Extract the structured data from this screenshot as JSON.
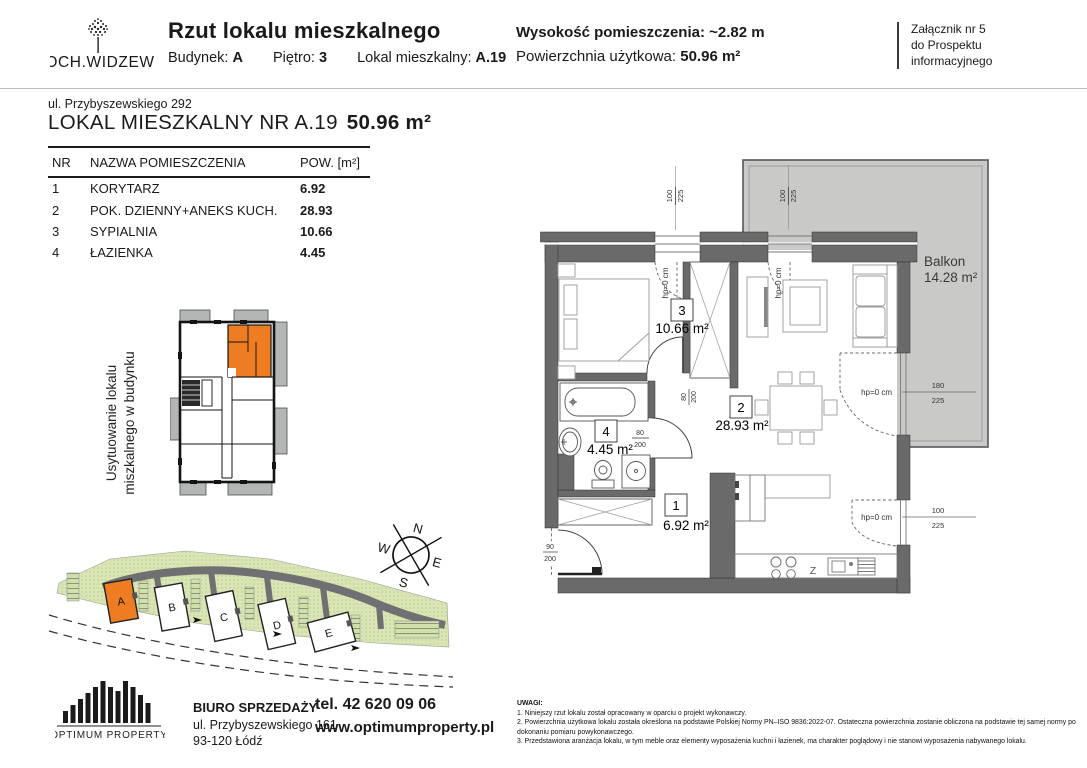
{
  "page": {
    "accent_orange": "#ee7c22",
    "wall_gray": "#6a6a6a",
    "balcony_gray": "#c9cac8"
  },
  "header": {
    "logo_text": "OCH.WIDZEW",
    "title": "Rzut lokalu mieszkalnego",
    "building_label": "Budynek:",
    "building_value": "A",
    "floor_label": "Piętro:",
    "floor_value": "3",
    "unit_label": "Lokal mieszkalny:",
    "unit_value": "A.19",
    "height_line": "Wysokość pomieszczenia: ~2.82 m",
    "area_label": "Powierzchnia użytkowa:",
    "area_value": "50.96 m²",
    "attachment_line1": "Załącznik nr 5",
    "attachment_line2": "do Prospektu",
    "attachment_line3": "informacyjnego"
  },
  "unit": {
    "address": "ul. Przybyszewskiego 292",
    "title": "LOKAL MIESZKALNY NR A.19",
    "title_area": "50.96 m²"
  },
  "rooms_table": {
    "col_nr": "NR",
    "col_name": "NAZWA POMIESZCZENIA",
    "col_area": "POW. [m²]",
    "rows": [
      {
        "nr": "1",
        "name": "KORYTARZ",
        "area": "6.92"
      },
      {
        "nr": "2",
        "name": "POK. DZIENNY+ANEKS KUCH.",
        "area": "28.93"
      },
      {
        "nr": "3",
        "name": "SYPIALNIA",
        "area": "10.66"
      },
      {
        "nr": "4",
        "name": "ŁAZIENKA",
        "area": "4.45"
      }
    ]
  },
  "location_diagram": {
    "label_line1": "Usytuowanie lokalu",
    "label_line2": "miszkalnego w budynku"
  },
  "site_map": {
    "building_a": "A",
    "building_b": "B",
    "building_c": "C",
    "building_d": "D",
    "building_e": "E",
    "compass_n": "N",
    "compass_e": "E",
    "compass_s": "S",
    "compass_w": "W"
  },
  "floor_plan": {
    "room1_nr": "1",
    "room1_area": "6.92 m²",
    "room2_nr": "2",
    "room2_area": "28.93 m²",
    "room3_nr": "3",
    "room3_area": "10.66 m²",
    "room4_nr": "4",
    "room4_area": "4.45 m²",
    "balcony_name": "Balkon",
    "balcony_area": "14.28 m²",
    "dim_hp": "hp=0 cm",
    "win_top_w": "100",
    "win_top_h": "225",
    "balcony_door_w": "180",
    "balcony_door_h": "225",
    "win_right_w": "100",
    "win_right_h": "225",
    "door_w": "80",
    "door_h": "200",
    "entry_w": "90",
    "entry_h": "200",
    "sink_label": "Z"
  },
  "footer": {
    "brand": "OPTIMUM PROPERTY",
    "office_title": "BIURO SPRZEDAŻY",
    "office_address": "ul. Przybyszewskiego 161",
    "office_city": "93-120 Łódź",
    "phone": "tel. 42 620 09 06",
    "website": "www.optimumproperty.pl"
  },
  "notes": {
    "title": "UWAGI:",
    "items": [
      "1. Niniejszy rzut lokalu został opracowany w oparciu o projekt wykonawczy.",
      "2. Powierzchnia użytkowa lokalu została określona na podstawie Polskiej Normy PN–ISO 9836:2022-07.  Ostateczna powierzchnia zostanie obliczona na podstawie tej samej normy po dokonaniu pomiaru powykonawczego.",
      "3. Przedstawiona aranżacja lokalu, w tym meble oraz elementy wyposażenia kuchni i łazienek, ma charakter poglądowy i nie stanowi wyposażenia nabywanego lokalu."
    ]
  }
}
